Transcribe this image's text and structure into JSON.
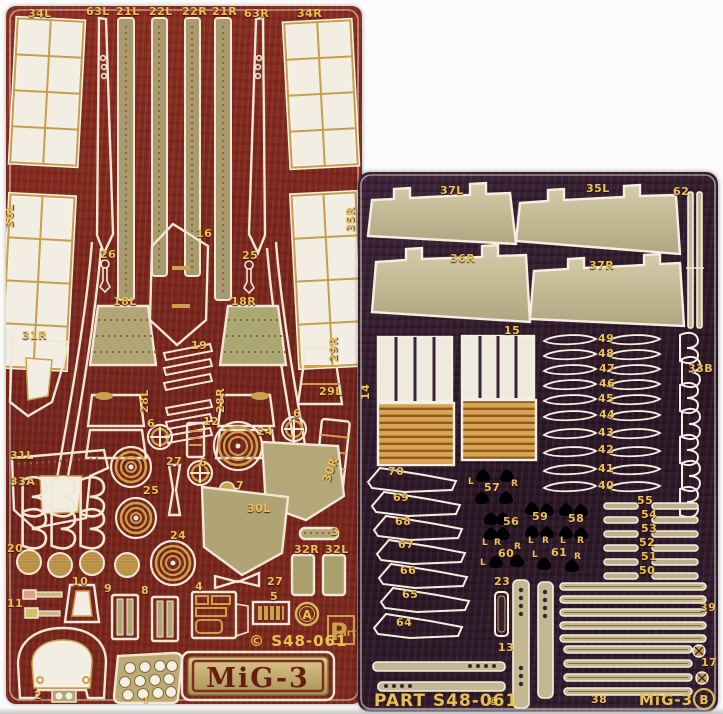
{
  "scene": {
    "type": "scanned photo of two photo-etched brass model-detail frets on white background",
    "subject": "MiG-3 1/48 scale photo-etch detail set, frets A and B"
  },
  "colors": {
    "gold_label": "#ecc355",
    "sheet_a_red": "#7c2a20",
    "sheet_b_purple": "#342031",
    "brass": "#b3a676",
    "outline_white": "#f1e7d4",
    "louver_orange": "#dda450",
    "plate_letters_red": "#681d12"
  },
  "sheet_a": {
    "frame_letter": "A",
    "brand_initial": "P",
    "brand_suffix": "art",
    "code_text": "© S48-061",
    "plate_text": "MiG-3",
    "labels": [
      {
        "t": "34L",
        "x": 22,
        "y": 2
      },
      {
        "t": "63L",
        "x": 80,
        "y": 0
      },
      {
        "t": "21L",
        "x": 110,
        "y": 0
      },
      {
        "t": "22L",
        "x": 143,
        "y": 0
      },
      {
        "t": "22R",
        "x": 176,
        "y": 0
      },
      {
        "t": "21R",
        "x": 206,
        "y": 0
      },
      {
        "t": "63R",
        "x": 238,
        "y": 2
      },
      {
        "t": "34R",
        "x": 291,
        "y": 2
      },
      {
        "t": "36L",
        "x": -2,
        "y": 192,
        "r": -90
      },
      {
        "t": "35R",
        "x": 339,
        "y": 196,
        "r": -90
      },
      {
        "t": "16",
        "x": 190,
        "y": 222
      },
      {
        "t": "26",
        "x": 94,
        "y": 243
      },
      {
        "t": "25",
        "x": 236,
        "y": 244
      },
      {
        "t": "18L",
        "x": 107,
        "y": 290
      },
      {
        "t": "18R",
        "x": 225,
        "y": 290
      },
      {
        "t": "31R",
        "x": 16,
        "y": 324
      },
      {
        "t": "29R",
        "x": 322,
        "y": 326,
        "r": -90
      },
      {
        "t": "19",
        "x": 185,
        "y": 334
      },
      {
        "t": "28L",
        "x": 133,
        "y": 377,
        "r": -90
      },
      {
        "t": "28R",
        "x": 209,
        "y": 377,
        "r": -90
      },
      {
        "t": "29L",
        "x": 313,
        "y": 380
      },
      {
        "t": "31L",
        "x": 4,
        "y": 444
      },
      {
        "t": "33A",
        "x": 4,
        "y": 470
      },
      {
        "t": "6",
        "x": 141,
        "y": 412
      },
      {
        "t": "12",
        "x": 197,
        "y": 410
      },
      {
        "t": "24",
        "x": 251,
        "y": 420
      },
      {
        "t": "6",
        "x": 287,
        "y": 402
      },
      {
        "t": "30R",
        "x": 315,
        "y": 444,
        "r": -70
      },
      {
        "t": "27",
        "x": 160,
        "y": 450
      },
      {
        "t": "6",
        "x": 193,
        "y": 451
      },
      {
        "t": "7",
        "x": 230,
        "y": 474
      },
      {
        "t": "25",
        "x": 137,
        "y": 479
      },
      {
        "t": "30L",
        "x": 241,
        "y": 497
      },
      {
        "t": "24",
        "x": 164,
        "y": 524
      },
      {
        "t": "20",
        "x": 1,
        "y": 537
      },
      {
        "t": "3",
        "x": 325,
        "y": 520
      },
      {
        "t": "32R",
        "x": 288,
        "y": 538
      },
      {
        "t": "32L",
        "x": 319,
        "y": 538
      },
      {
        "t": "10",
        "x": 66,
        "y": 570
      },
      {
        "t": "9",
        "x": 98,
        "y": 577
      },
      {
        "t": "8",
        "x": 135,
        "y": 579
      },
      {
        "t": "4",
        "x": 189,
        "y": 575
      },
      {
        "t": "27",
        "x": 261,
        "y": 570
      },
      {
        "t": "5",
        "x": 264,
        "y": 585
      },
      {
        "t": "11",
        "x": 1,
        "y": 592
      },
      {
        "t": "2",
        "x": 28,
        "y": 684
      },
      {
        "t": "1",
        "x": 136,
        "y": 690
      }
    ]
  },
  "sheet_b": {
    "frame_letter": "B",
    "footer_code": "PART S48-061",
    "footer_mark": "©",
    "footer_name": "MiG-3",
    "labels": [
      {
        "t": "37L",
        "x": 82,
        "y": 13
      },
      {
        "t": "35L",
        "x": 228,
        "y": 11
      },
      {
        "t": "62",
        "x": 315,
        "y": 14
      },
      {
        "t": "36R",
        "x": 92,
        "y": 81
      },
      {
        "t": "37R",
        "x": 231,
        "y": 88
      },
      {
        "t": "15",
        "x": 146,
        "y": 153
      },
      {
        "t": "14",
        "x": 2,
        "y": 198,
        "r": -90
      },
      {
        "t": "49",
        "x": 240,
        "y": 161
      },
      {
        "t": "48",
        "x": 240,
        "y": 176
      },
      {
        "t": "47",
        "x": 241,
        "y": 191
      },
      {
        "t": "46",
        "x": 241,
        "y": 206
      },
      {
        "t": "45",
        "x": 240,
        "y": 221
      },
      {
        "t": "44",
        "x": 241,
        "y": 237
      },
      {
        "t": "43",
        "x": 240,
        "y": 255
      },
      {
        "t": "42",
        "x": 240,
        "y": 272
      },
      {
        "t": "41",
        "x": 240,
        "y": 291
      },
      {
        "t": "40",
        "x": 240,
        "y": 308
      },
      {
        "t": "33B",
        "x": 330,
        "y": 191
      },
      {
        "t": "70",
        "x": 30,
        "y": 294
      },
      {
        "t": "69",
        "x": 35,
        "y": 320
      },
      {
        "t": "68",
        "x": 37,
        "y": 344
      },
      {
        "t": "67",
        "x": 40,
        "y": 367
      },
      {
        "t": "66",
        "x": 42,
        "y": 393
      },
      {
        "t": "65",
        "x": 44,
        "y": 417
      },
      {
        "t": "64",
        "x": 38,
        "y": 445
      },
      {
        "t": "L",
        "x": 110,
        "y": 306,
        "s": 9
      },
      {
        "t": "57",
        "x": 126,
        "y": 310
      },
      {
        "t": "R",
        "x": 153,
        "y": 308,
        "s": 9
      },
      {
        "t": "56",
        "x": 145,
        "y": 344
      },
      {
        "t": "L",
        "x": 124,
        "y": 367,
        "s": 9
      },
      {
        "t": "R",
        "x": 136,
        "y": 367,
        "s": 9
      },
      {
        "t": "59",
        "x": 174,
        "y": 339
      },
      {
        "t": "L",
        "x": 170,
        "y": 365,
        "s": 9
      },
      {
        "t": "R",
        "x": 184,
        "y": 365,
        "s": 9
      },
      {
        "t": "58",
        "x": 210,
        "y": 341
      },
      {
        "t": "L",
        "x": 202,
        "y": 365,
        "s": 9
      },
      {
        "t": "R",
        "x": 219,
        "y": 365,
        "s": 9
      },
      {
        "t": "60",
        "x": 140,
        "y": 376
      },
      {
        "t": "R",
        "x": 156,
        "y": 371,
        "s": 9
      },
      {
        "t": "L",
        "x": 122,
        "y": 387,
        "s": 9
      },
      {
        "t": "61",
        "x": 193,
        "y": 375
      },
      {
        "t": "L",
        "x": 174,
        "y": 379,
        "s": 9
      },
      {
        "t": "R",
        "x": 216,
        "y": 381,
        "s": 9
      },
      {
        "t": "55",
        "x": 279,
        "y": 323
      },
      {
        "t": "54",
        "x": 283,
        "y": 337
      },
      {
        "t": "53",
        "x": 283,
        "y": 351
      },
      {
        "t": "52",
        "x": 281,
        "y": 365
      },
      {
        "t": "51",
        "x": 283,
        "y": 379
      },
      {
        "t": "50",
        "x": 281,
        "y": 393
      },
      {
        "t": "23",
        "x": 136,
        "y": 404
      },
      {
        "t": "13",
        "x": 140,
        "y": 470
      },
      {
        "t": "39",
        "x": 342,
        "y": 430
      },
      {
        "t": "17",
        "x": 343,
        "y": 485
      },
      {
        "t": "38",
        "x": 233,
        "y": 522
      }
    ]
  }
}
